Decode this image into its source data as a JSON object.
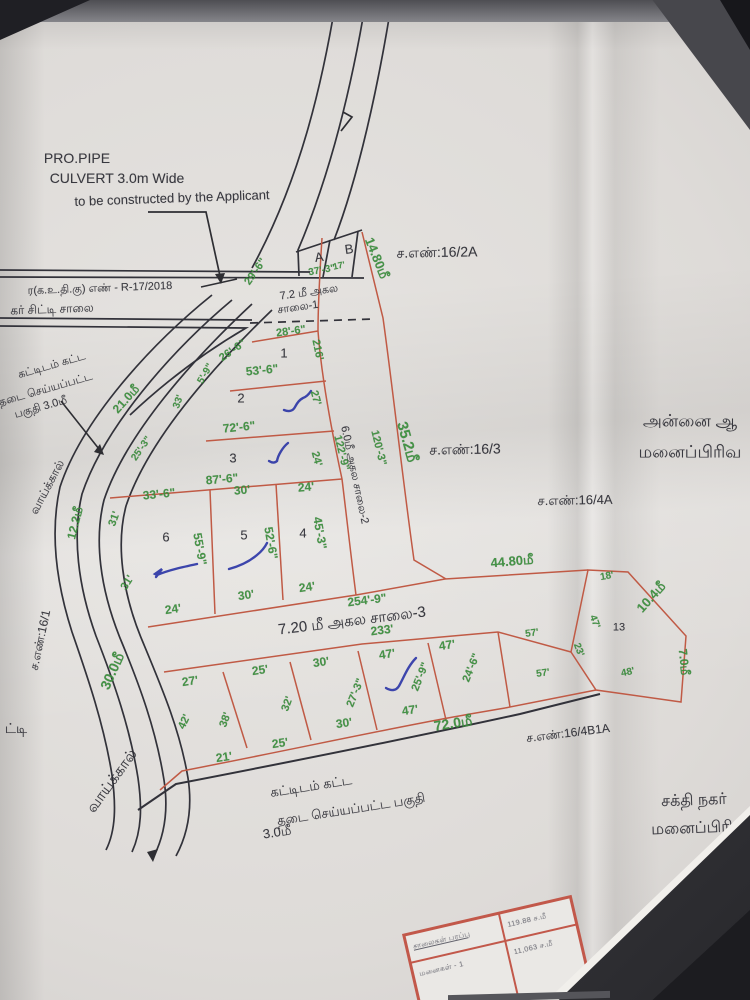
{
  "colors": {
    "dimension_green": "#3c8f3e",
    "plot_line_red": "#c05a45",
    "ink_black": "#2e2e36",
    "pen_blue": "#2a34a6",
    "paper": "#e2e0dd"
  },
  "labels": [
    {
      "n": "note-pro-pipe",
      "t": "PRO.PIPE",
      "x": 77,
      "y": 158,
      "r": 0,
      "c": "k",
      "s": 14
    },
    {
      "n": "note-culvert",
      "t": "CULVERT 3.0m Wide",
      "x": 117,
      "y": 178,
      "r": 0,
      "c": "k",
      "s": 14
    },
    {
      "n": "note-constructed",
      "t": "to be constructed by the Applicant",
      "x": 172,
      "y": 198,
      "r": -2,
      "c": "k",
      "s": 13
    },
    {
      "n": "approval-ref",
      "t": "ர(க.உ.தி.கு) எண் - R-17/2018",
      "x": 100,
      "y": 289,
      "r": -2,
      "c": "k",
      "s": 11
    },
    {
      "n": "city-road-label",
      "t": "கர் சிட்டி சாலை",
      "x": 52,
      "y": 309,
      "r": -2,
      "c": "k",
      "s": 12
    },
    {
      "n": "dim-29-6",
      "t": "29'-6\"",
      "x": 256,
      "y": 272,
      "r": -55,
      "c": "g",
      "s": 11
    },
    {
      "n": "plot-a",
      "t": "A",
      "x": 319,
      "y": 257,
      "r": -8,
      "c": "k",
      "s": 13
    },
    {
      "n": "plot-b",
      "t": "B",
      "x": 349,
      "y": 249,
      "r": -8,
      "c": "k",
      "s": 13
    },
    {
      "n": "dim-37-3",
      "t": "37'-3\"",
      "x": 322,
      "y": 271,
      "r": -10,
      "c": "g",
      "s": 10
    },
    {
      "n": "dim-17",
      "t": "17'",
      "x": 339,
      "y": 266,
      "r": -12,
      "c": "g",
      "s": 9
    },
    {
      "n": "dim-14-80m",
      "t": "14.80மீ",
      "x": 377,
      "y": 258,
      "r": 68,
      "c": "g",
      "s": 13
    },
    {
      "n": "survey-16-2a",
      "t": "ச.எண்:16/2A",
      "x": 437,
      "y": 252,
      "r": -1,
      "c": "k",
      "s": 14
    },
    {
      "n": "road1-width",
      "t": "7.2 மீ அகல",
      "x": 309,
      "y": 293,
      "r": -8,
      "c": "k",
      "s": 11
    },
    {
      "n": "road1-name",
      "t": "சாலை-1",
      "x": 298,
      "y": 308,
      "r": -8,
      "c": "k",
      "s": 11
    },
    {
      "n": "dim-28-6",
      "t": "28'-6\"",
      "x": 291,
      "y": 332,
      "r": -8,
      "c": "g",
      "s": 11
    },
    {
      "n": "dim-216",
      "t": "216'",
      "x": 317,
      "y": 350,
      "r": 78,
      "c": "g",
      "s": 11
    },
    {
      "n": "plot-1",
      "t": "1",
      "x": 284,
      "y": 353,
      "r": 0,
      "c": "k",
      "s": 13
    },
    {
      "n": "dim-26-6",
      "t": "26'-6\"",
      "x": 233,
      "y": 351,
      "r": -35,
      "c": "g",
      "s": 11
    },
    {
      "n": "dim-5-9",
      "t": "5'-9\"",
      "x": 206,
      "y": 374,
      "r": -60,
      "c": "g",
      "s": 10
    },
    {
      "n": "dim-33",
      "t": "33'",
      "x": 179,
      "y": 402,
      "r": -70,
      "c": "g",
      "s": 10
    },
    {
      "n": "dim-53-6",
      "t": "53'-6\"",
      "x": 262,
      "y": 370,
      "r": -6,
      "c": "g",
      "s": 12
    },
    {
      "n": "plot-2",
      "t": "2",
      "x": 241,
      "y": 398,
      "r": 0,
      "c": "k",
      "s": 13
    },
    {
      "n": "dim-27-r",
      "t": "27'",
      "x": 315,
      "y": 398,
      "r": 75,
      "c": "g",
      "s": 11
    },
    {
      "n": "dim-72-6",
      "t": "72'-6\"",
      "x": 239,
      "y": 427,
      "r": -6,
      "c": "g",
      "s": 12
    },
    {
      "n": "plot-3",
      "t": "3",
      "x": 233,
      "y": 458,
      "r": 0,
      "c": "k",
      "s": 13
    },
    {
      "n": "dim-24-r",
      "t": "24'",
      "x": 316,
      "y": 459,
      "r": 75,
      "c": "g",
      "s": 11
    },
    {
      "n": "dim-87-6",
      "t": "87'-6\"",
      "x": 222,
      "y": 479,
      "r": -5,
      "c": "g",
      "s": 12
    },
    {
      "n": "dim-21-0m",
      "t": "21.0மீ",
      "x": 126,
      "y": 399,
      "r": -48,
      "c": "g",
      "s": 12
    },
    {
      "n": "dim-25-3",
      "t": "25'-3\"",
      "x": 142,
      "y": 449,
      "r": -55,
      "c": "g",
      "s": 10
    },
    {
      "n": "dim-12-2m",
      "t": "12.2மீ",
      "x": 75,
      "y": 523,
      "r": -76,
      "c": "g",
      "s": 12
    },
    {
      "n": "dim-33-6",
      "t": "33'-6\"",
      "x": 159,
      "y": 494,
      "r": -6,
      "c": "g",
      "s": 12
    },
    {
      "n": "dim-30-t5",
      "t": "30'",
      "x": 242,
      "y": 490,
      "r": -5,
      "c": "g",
      "s": 12
    },
    {
      "n": "dim-24-t4",
      "t": "24'",
      "x": 306,
      "y": 487,
      "r": -5,
      "c": "g",
      "s": 12
    },
    {
      "n": "dim-31-a",
      "t": "31'",
      "x": 115,
      "y": 519,
      "r": -70,
      "c": "g",
      "s": 11
    },
    {
      "n": "dim-31-b",
      "t": "31'",
      "x": 128,
      "y": 583,
      "r": -58,
      "c": "g",
      "s": 11
    },
    {
      "n": "plot-6",
      "t": "6",
      "x": 166,
      "y": 537,
      "r": 0,
      "c": "k",
      "s": 13
    },
    {
      "n": "dim-55-9",
      "t": "55'-9\"",
      "x": 200,
      "y": 549,
      "r": 80,
      "c": "g",
      "s": 12
    },
    {
      "n": "plot-5",
      "t": "5",
      "x": 244,
      "y": 535,
      "r": 0,
      "c": "k",
      "s": 13
    },
    {
      "n": "dim-52-6",
      "t": "52'-6\"",
      "x": 271,
      "y": 543,
      "r": 80,
      "c": "g",
      "s": 12
    },
    {
      "n": "plot-4",
      "t": "4",
      "x": 303,
      "y": 533,
      "r": 0,
      "c": "k",
      "s": 13
    },
    {
      "n": "dim-45-3",
      "t": "45'-3\"",
      "x": 320,
      "y": 533,
      "r": 80,
      "c": "g",
      "s": 12
    },
    {
      "n": "dim-122-9",
      "t": "122'-9\"",
      "x": 341,
      "y": 453,
      "r": 76,
      "c": "g",
      "s": 11
    },
    {
      "n": "road2-name",
      "t": "6.0மீ அகல சாலை-2",
      "x": 354,
      "y": 475,
      "r": 78,
      "c": "k",
      "s": 11
    },
    {
      "n": "dim-120-3",
      "t": "120'-3\"",
      "x": 378,
      "y": 448,
      "r": 76,
      "c": "g",
      "s": 11
    },
    {
      "n": "dim-35-2m",
      "t": "35.2மீ",
      "x": 407,
      "y": 442,
      "r": 74,
      "c": "g",
      "s": 15
    },
    {
      "n": "survey-16-3",
      "t": "ச.எண்:16/3",
      "x": 465,
      "y": 449,
      "r": -1,
      "c": "k",
      "s": 14
    },
    {
      "n": "survey-16-4a",
      "t": "ச.எண்:16/4A",
      "x": 575,
      "y": 500,
      "r": -1,
      "c": "k",
      "s": 13
    },
    {
      "n": "dim-24-b6",
      "t": "24'",
      "x": 173,
      "y": 609,
      "r": -8,
      "c": "g",
      "s": 12
    },
    {
      "n": "dim-30-b5",
      "t": "30'",
      "x": 246,
      "y": 595,
      "r": -8,
      "c": "g",
      "s": 12
    },
    {
      "n": "dim-24-b4",
      "t": "24'",
      "x": 307,
      "y": 587,
      "r": -8,
      "c": "g",
      "s": 12
    },
    {
      "n": "dim-44-80m",
      "t": "44.80மீ",
      "x": 512,
      "y": 561,
      "r": -5,
      "c": "g",
      "s": 13
    },
    {
      "n": "dim-18",
      "t": "18'",
      "x": 607,
      "y": 577,
      "r": -10,
      "c": "g",
      "s": 10
    },
    {
      "n": "dim-10-4m",
      "t": "10.4மீ",
      "x": 651,
      "y": 597,
      "r": -48,
      "c": "g",
      "s": 13
    },
    {
      "n": "plot-13",
      "t": "13",
      "x": 619,
      "y": 628,
      "r": 0,
      "c": "k",
      "s": 11
    },
    {
      "n": "dim-47-13",
      "t": "47'",
      "x": 594,
      "y": 622,
      "r": 70,
      "c": "g",
      "s": 10
    },
    {
      "n": "dim-23",
      "t": "23'",
      "x": 578,
      "y": 650,
      "r": 70,
      "c": "g",
      "s": 10
    },
    {
      "n": "dim-57-a",
      "t": "57'",
      "x": 532,
      "y": 634,
      "r": -8,
      "c": "g",
      "s": 10
    },
    {
      "n": "dim-57-b",
      "t": "57'",
      "x": 543,
      "y": 674,
      "r": -8,
      "c": "g",
      "s": 10
    },
    {
      "n": "dim-48",
      "t": "48'",
      "x": 628,
      "y": 673,
      "r": -12,
      "c": "g",
      "s": 10
    },
    {
      "n": "dim-7-0m",
      "t": "7.0மீ",
      "x": 684,
      "y": 662,
      "r": 84,
      "c": "g",
      "s": 12
    },
    {
      "n": "dim-254-9",
      "t": "254'-9\"",
      "x": 367,
      "y": 600,
      "r": -7,
      "c": "g",
      "s": 12
    },
    {
      "n": "road3-name",
      "t": "7.20 மீ அகல சாலை-3",
      "x": 352,
      "y": 621,
      "r": -7,
      "c": "k",
      "s": 15
    },
    {
      "n": "dim-233",
      "t": "233'",
      "x": 382,
      "y": 630,
      "r": -7,
      "c": "g",
      "s": 12
    },
    {
      "n": "dim-27-b",
      "t": "27'",
      "x": 190,
      "y": 681,
      "r": -8,
      "c": "g",
      "s": 12
    },
    {
      "n": "dim-25-b",
      "t": "25'",
      "x": 260,
      "y": 670,
      "r": -8,
      "c": "g",
      "s": 12
    },
    {
      "n": "dim-30-c",
      "t": "30'",
      "x": 321,
      "y": 662,
      "r": -8,
      "c": "g",
      "s": 12
    },
    {
      "n": "dim-47-a",
      "t": "47'",
      "x": 387,
      "y": 654,
      "r": -8,
      "c": "g",
      "s": 12
    },
    {
      "n": "dim-47-b",
      "t": "47'",
      "x": 447,
      "y": 645,
      "r": -8,
      "c": "g",
      "s": 12
    },
    {
      "n": "dim-42",
      "t": "42'",
      "x": 185,
      "y": 722,
      "r": -65,
      "c": "g",
      "s": 11
    },
    {
      "n": "dim-38",
      "t": "38'",
      "x": 226,
      "y": 720,
      "r": -70,
      "c": "g",
      "s": 11
    },
    {
      "n": "dim-32",
      "t": "32'",
      "x": 288,
      "y": 704,
      "r": -70,
      "c": "g",
      "s": 11
    },
    {
      "n": "dim-27-3",
      "t": "27'-3\"",
      "x": 356,
      "y": 693,
      "r": -68,
      "c": "g",
      "s": 11
    },
    {
      "n": "dim-25-9",
      "t": "25'-9\"",
      "x": 421,
      "y": 677,
      "r": -68,
      "c": "g",
      "s": 11
    },
    {
      "n": "dim-24-6",
      "t": "24'-6\"",
      "x": 472,
      "y": 668,
      "r": -68,
      "c": "g",
      "s": 11
    },
    {
      "n": "dim-30-d",
      "t": "30'",
      "x": 344,
      "y": 723,
      "r": -8,
      "c": "g",
      "s": 12
    },
    {
      "n": "dim-47-c",
      "t": "47'",
      "x": 410,
      "y": 710,
      "r": -8,
      "c": "g",
      "s": 12
    },
    {
      "n": "dim-21",
      "t": "21'",
      "x": 224,
      "y": 757,
      "r": -8,
      "c": "g",
      "s": 12
    },
    {
      "n": "dim-25-c",
      "t": "25'",
      "x": 280,
      "y": 743,
      "r": -8,
      "c": "g",
      "s": 12
    },
    {
      "n": "dim-72-0m",
      "t": "72.0மீ",
      "x": 453,
      "y": 723,
      "r": -9,
      "c": "g",
      "s": 14
    },
    {
      "n": "survey-16-4b1a",
      "t": "ச.எண்:16/4B1A",
      "x": 568,
      "y": 733,
      "r": -7,
      "c": "k",
      "s": 12
    },
    {
      "n": "subdiv-right-line1",
      "t": "அன்னை ஆ",
      "x": 690,
      "y": 421,
      "r": 0,
      "c": "k",
      "s": 17
    },
    {
      "n": "subdiv-right-line2",
      "t": "மனைப்பிரிவ",
      "x": 690,
      "y": 452,
      "r": 0,
      "c": "k",
      "s": 17
    },
    {
      "n": "subdiv-sakthi-line1",
      "t": "சக்தி நகர்",
      "x": 694,
      "y": 801,
      "r": -2,
      "c": "k",
      "s": 16
    },
    {
      "n": "subdiv-sakthi-line2",
      "t": "மனைப்பிரி",
      "x": 692,
      "y": 829,
      "r": -2,
      "c": "k",
      "s": 16
    },
    {
      "n": "restricted-upperleft-line1",
      "t": "கட்டிடம் கட்ட",
      "x": 52,
      "y": 366,
      "r": -16,
      "c": "k",
      "s": 11
    },
    {
      "n": "restricted-upperleft-line2",
      "t": "தடை செய்யப்பட்ட",
      "x": 46,
      "y": 390,
      "r": -16,
      "c": "k",
      "s": 11
    },
    {
      "n": "restricted-upperleft-line3",
      "t": "பகுதி 3.0மீ",
      "x": 41,
      "y": 408,
      "r": -16,
      "c": "k",
      "s": 11
    },
    {
      "n": "restricted-bottom-line1",
      "t": "கட்டிடம் கட்ட",
      "x": 311,
      "y": 786,
      "r": -9,
      "c": "k",
      "s": 13
    },
    {
      "n": "restricted-bottom-line2",
      "t": "தடை செய்யப்பட்ட பகுதி",
      "x": 351,
      "y": 809,
      "r": -9,
      "c": "k",
      "s": 13
    },
    {
      "n": "restricted-bottom-line3",
      "t": "3.0மீ",
      "x": 277,
      "y": 832,
      "r": -9,
      "c": "k",
      "s": 13
    },
    {
      "n": "canal-label-upper",
      "t": "வாய்க்கால்",
      "x": 47,
      "y": 487,
      "r": -62,
      "c": "k",
      "s": 12
    },
    {
      "n": "canal-label-lower",
      "t": "வாய்க்கால்",
      "x": 112,
      "y": 781,
      "r": -54,
      "c": "k",
      "s": 15
    },
    {
      "n": "survey-16-1",
      "t": "ச.எண்:16/1",
      "x": 40,
      "y": 640,
      "r": -78,
      "c": "k",
      "s": 12
    },
    {
      "n": "dim-30-0m",
      "t": "30.0மீ",
      "x": 112,
      "y": 671,
      "r": -66,
      "c": "g",
      "s": 14
    },
    {
      "n": "edge-text-tti",
      "t": "ட்டி",
      "x": 16,
      "y": 728,
      "r": 0,
      "c": "k",
      "s": 14
    }
  ],
  "table": {
    "rows": [
      [
        "சாலைகள் பரப்பு",
        "119.88 ச.மீ"
      ],
      [
        "மனைகள் - 1",
        "11,063 ச.மீ"
      ]
    ]
  }
}
